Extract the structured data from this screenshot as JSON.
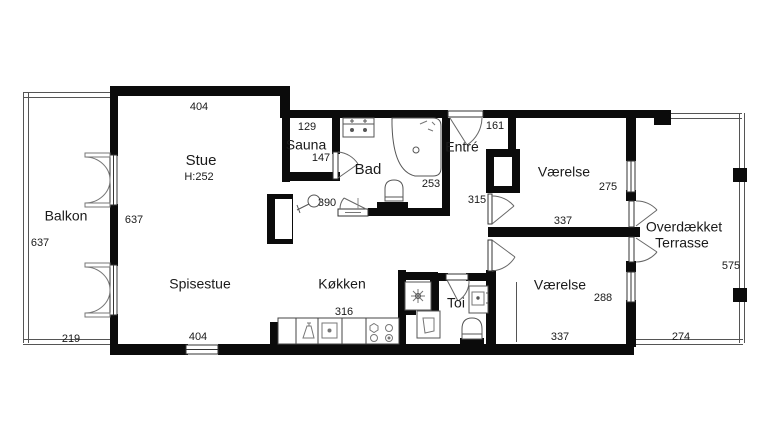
{
  "title": "Apartment floor plan",
  "colors": {
    "wall": "#0b0b0b",
    "background": "#ffffff",
    "thin_line": "#555555"
  },
  "rooms": {
    "balkon": {
      "name": "Balkon"
    },
    "stue": {
      "name": "Stue",
      "ceiling_height": "H:252"
    },
    "spisestue": {
      "name": "Spisestue"
    },
    "sauna": {
      "name": "Sauna"
    },
    "bad": {
      "name": "Bad"
    },
    "entre": {
      "name": "Entré"
    },
    "koekken": {
      "name": "Køkken"
    },
    "toi": {
      "name": "Toi"
    },
    "vaerelse_1": {
      "name": "Værelse"
    },
    "vaerelse_2": {
      "name": "Værelse"
    },
    "terrasse": {
      "name_line1": "Overdækket",
      "name_line2": "Terrasse"
    }
  },
  "dimensions": {
    "balkon_height_left": "637",
    "balkon_width_bottom": "219",
    "stue_width_top": "404",
    "stue_height_right": "637",
    "spisestue_width_bottom": "404",
    "sauna_width_top": "129",
    "sauna_inner": "147",
    "bad_depth_right": "253",
    "hall_width": "390",
    "entre_door_width": "161",
    "corridor_width": "315",
    "koekken_counter": "316",
    "vaerelse1_depth_right": "275",
    "vaerelse1_width_bottom": "337",
    "vaerelse2_depth_right": "288",
    "vaerelse2_width_bottom": "337",
    "terrasse_height_right": "575",
    "terrasse_width_bottom": "274"
  },
  "fixtures": [
    "bathtub-icon",
    "vanity-sink-icon",
    "toilet-icon",
    "shower-mixer-icon",
    "washing-machine-icon",
    "cabinet-icon",
    "hand-sink-icon",
    "toilet-icon",
    "dishwasher-icon",
    "kitchen-sink-icon",
    "stove-icon",
    "fireplace-icon",
    "double-door-icon",
    "door-arc-icon",
    "window-icon"
  ]
}
